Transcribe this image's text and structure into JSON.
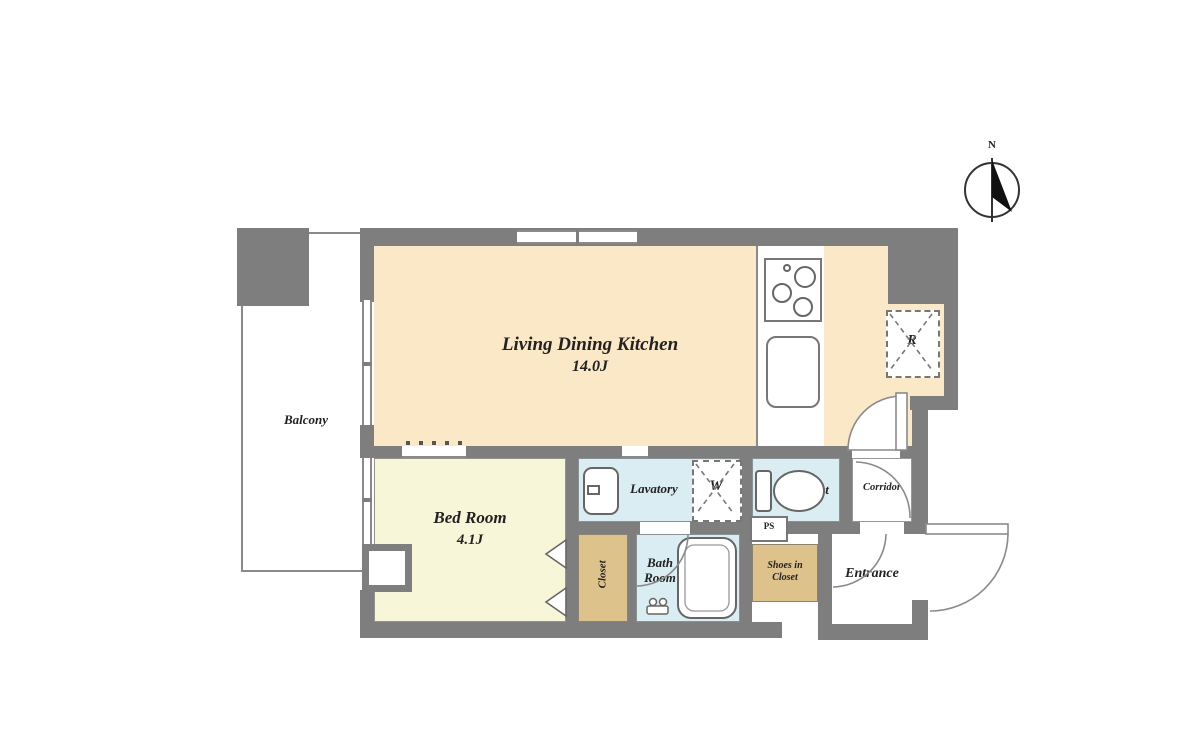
{
  "compass": {
    "label": "N"
  },
  "rooms": {
    "ldk": {
      "name": "Living Dining Kitchen",
      "size": "14.0J"
    },
    "bedroom": {
      "name": "Bed Room",
      "size": "4.1J"
    },
    "balcony": {
      "name": "Balcony"
    },
    "lavatory": {
      "name": "Lavatory"
    },
    "toilet": {
      "name": "Toilet"
    },
    "bath_room": {
      "name": "Bath Room"
    },
    "closet": {
      "name": "Closet"
    },
    "shoes_in_closet": {
      "name": "Shoes in Closet"
    },
    "entrance": {
      "name": "Entrance"
    },
    "corridor": {
      "name": "Corridor"
    }
  },
  "markers": {
    "refrigerator": "R",
    "washing_machine": "W",
    "pipe_space": "PS"
  },
  "colors": {
    "wall": "#7e7e7e",
    "ldk": "#fbe8c6",
    "bedroom": "#f8f6d8",
    "wet_area": "#daedf2",
    "storage": "#dec28c",
    "outline": "#6a6a6a",
    "text": "#222222"
  }
}
